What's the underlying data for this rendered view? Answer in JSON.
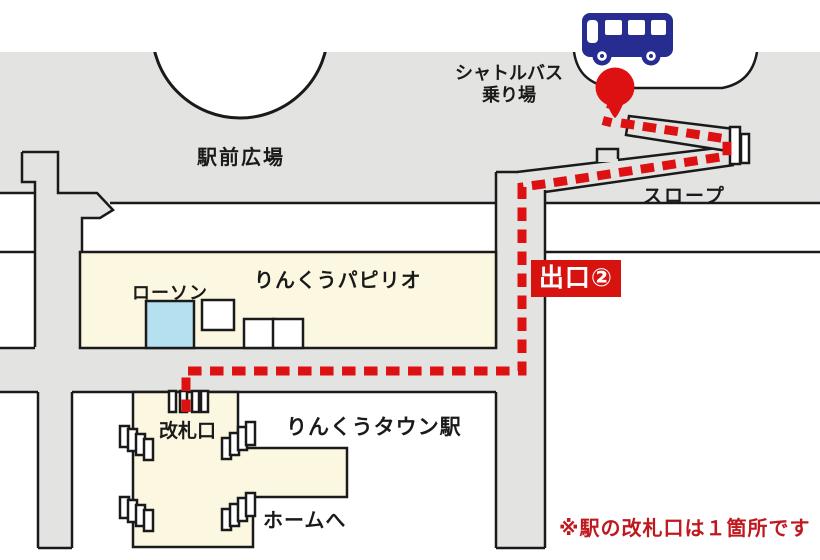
{
  "map": {
    "plaza_label": "駅前広場",
    "shuttle_stop": {
      "line1": "シャトルバス",
      "line2": "乗り場"
    },
    "slope_label": "スロープ",
    "exit_badge": "出口②",
    "papilio_label": "りんくうパピリオ",
    "lawson_label": "ローソン",
    "ticket_gate_label": "改札口",
    "station_label": "りんくうタウン駅",
    "platform_label": "ホームへ",
    "note": "※駅の改札口は１箇所です"
  },
  "colors": {
    "road_gray": "#e3e3e2",
    "building_cream": "#fbf7e1",
    "lawson_blue": "#b5e0f0",
    "route_red": "#dd1111",
    "exit_badge_bg": "#d6130f",
    "note_red": "#c0181f",
    "bus_navy": "#262c90",
    "outline": "#1a1a1a"
  }
}
